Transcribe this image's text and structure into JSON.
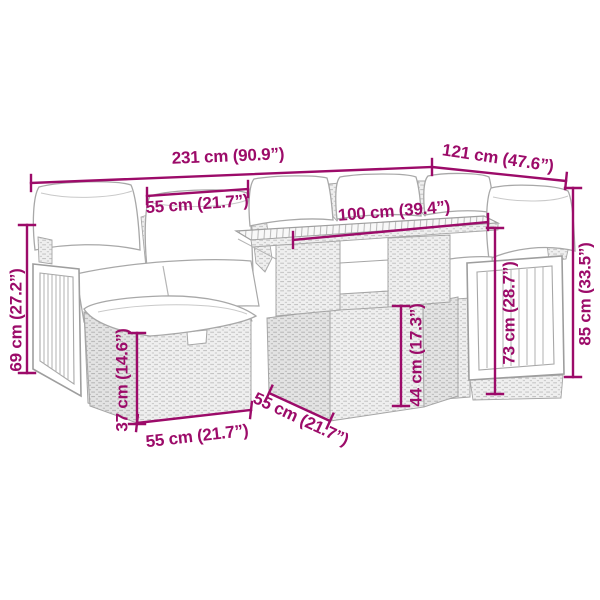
{
  "page": {
    "type": "product-dimension-diagram",
    "subject": "rattan garden lounge set with table and footstools"
  },
  "colors": {
    "dimension_annotation": "#9c0b69",
    "sketch_outline": "#a6a6a6",
    "background": "#ffffff"
  },
  "dimensions": {
    "overall_width": "231 cm (90.9”)",
    "overall_depth": "121 cm (47.6”)",
    "seat_width": "55 cm (21.7”)",
    "table_length": "100 cm (39.4”)",
    "backrest_height": "69 cm (27.2”)",
    "footstool_height": "37 cm (14.6”)",
    "footstool_width": "55 cm (21.7”)",
    "footstool_depth": "55 cm (21.7”)",
    "table_height": "44 cm (17.3”)",
    "side_panel_height": "73 cm (28.7”)",
    "overall_height": "85 cm (33.5”)"
  }
}
